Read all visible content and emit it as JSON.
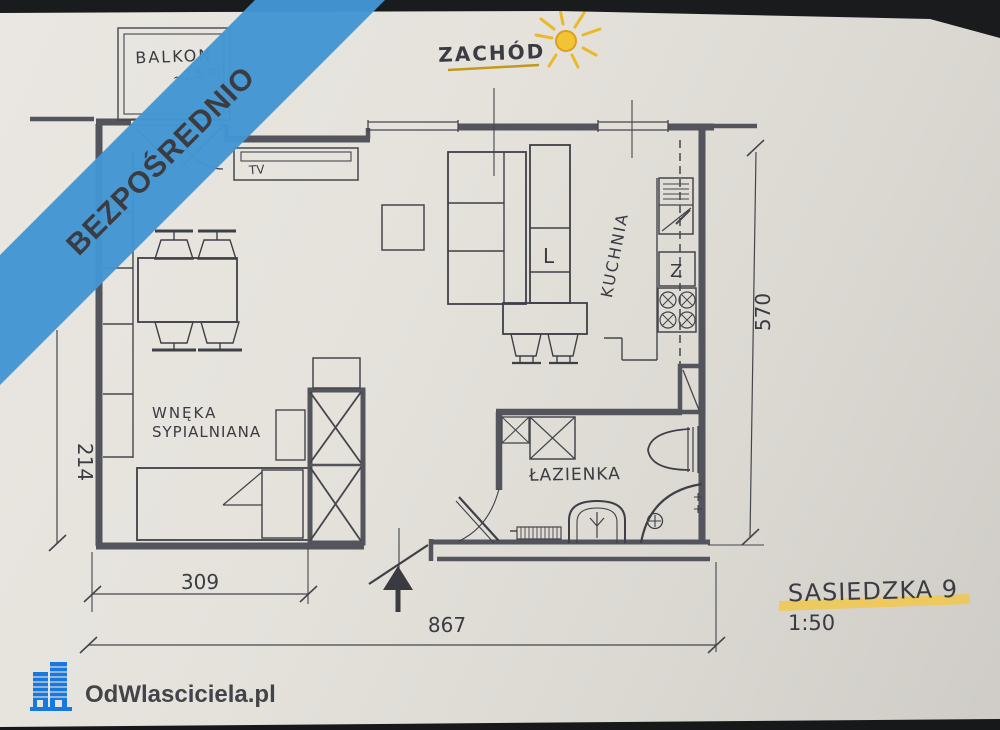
{
  "colors": {
    "banner_blue": "#4296d3",
    "ink": "#3b3c42",
    "wall": "#53545c",
    "paper": "#e4e1db",
    "compass_gold": "#b08818",
    "sun_yellow": "#f2c335",
    "highlight_yellow": "#f1c84b",
    "logo_blue": "#1778df"
  },
  "banner": {
    "label": "BEZPOŚREDNIO"
  },
  "compass": {
    "label": "ZACHÓD",
    "icon": "sun-icon"
  },
  "plan": {
    "balcony": {
      "label": "BALKON",
      "area": "~2,5 m²"
    },
    "tv": {
      "label": "TV"
    },
    "kitchen": {
      "label": "KUCHNIA",
      "fridge": "L",
      "appliance": "Z"
    },
    "bathroom": {
      "label": "ŁAZIENKA"
    },
    "nook": {
      "line1": "WNĘKA",
      "line2": "SYPIALNIANA"
    },
    "dims": {
      "right": "570",
      "left": "214",
      "bottom_inner": "309",
      "bottom_total": "867"
    }
  },
  "title": {
    "street": "SASIEDZKA 9",
    "scale": "1:50"
  },
  "watermark": {
    "label": "OdWlasciciela.pl"
  }
}
